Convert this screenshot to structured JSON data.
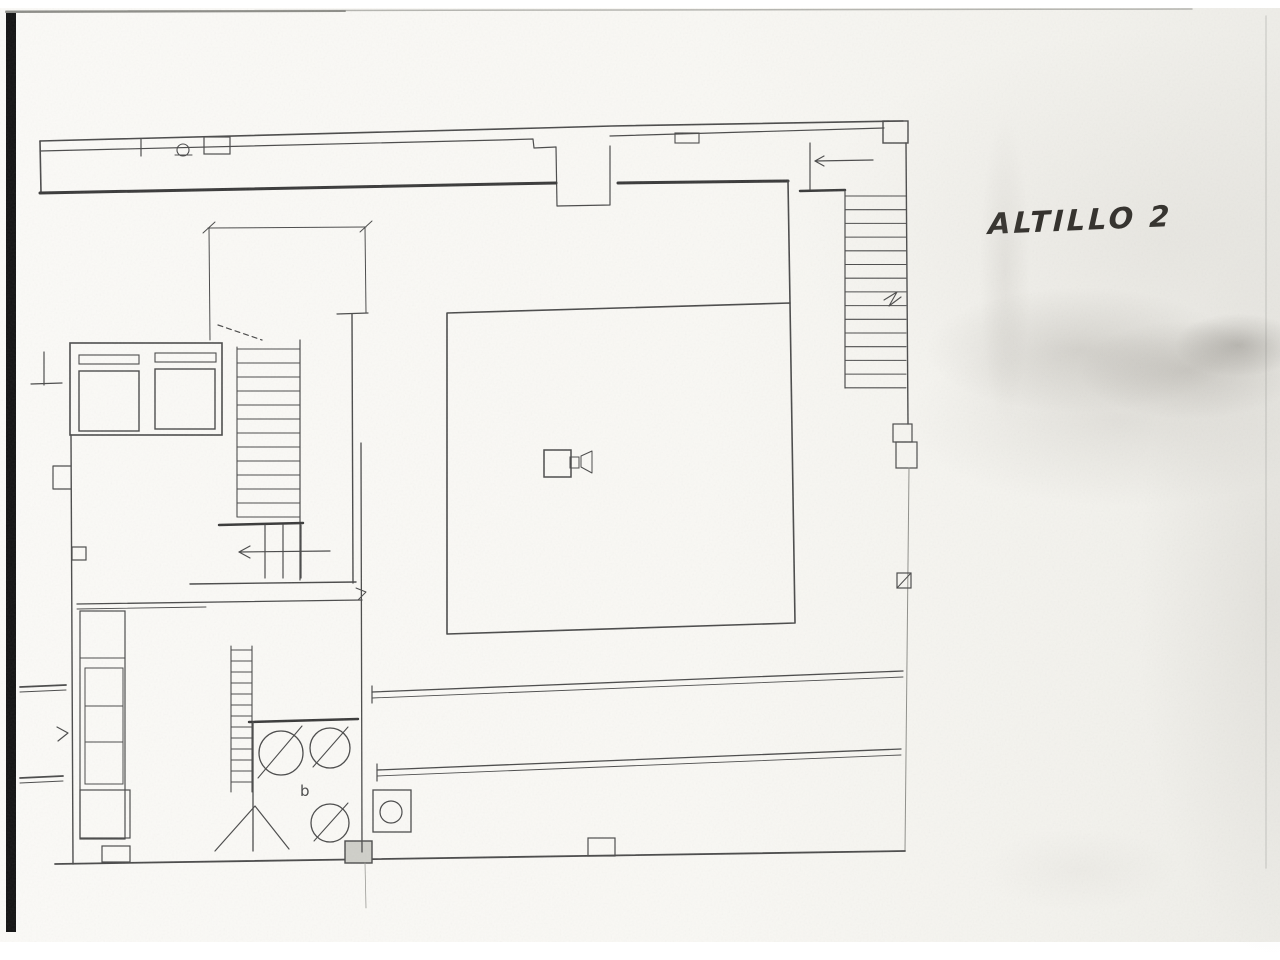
{
  "page": {
    "background": "#ffffff",
    "paper_color": "#f9f8f4",
    "ink_color": "#4b4b4b",
    "heavy_ink_color": "#3a3a3a",
    "faint_ink_color": "#8f8f8a",
    "scan_bar_color": "#111111"
  },
  "label": {
    "text": "ALTILLO 2"
  },
  "drawing": {
    "width": 1280,
    "height": 960,
    "elements": [
      {
        "n": "scan-left-bar",
        "t": "rect",
        "x": 6,
        "y": 12,
        "wd": 10,
        "ht": 920,
        "sw": 0,
        "fill": "#131313"
      },
      {
        "n": "scan-top-edge",
        "t": "line",
        "x1": 6,
        "y1": 11,
        "x2": 1192,
        "y2": 9,
        "w": 1.5,
        "color": "#b5b5b0"
      },
      {
        "n": "scan-top-edge-dark",
        "t": "line",
        "x1": 6,
        "y1": 12,
        "x2": 345,
        "y2": 11,
        "w": 2,
        "color": "#8d8d88"
      },
      {
        "n": "scan-right-edge",
        "t": "line",
        "x1": 1266,
        "y1": 16,
        "x2": 1266,
        "y2": 868,
        "w": 1.5,
        "color": "#d2d2cd"
      },
      {
        "n": "top-wall-outer",
        "t": "polyline",
        "pts": [
          [
            40,
            141
          ],
          [
            540,
            128
          ],
          [
            612,
            126
          ],
          [
            903,
            121
          ]
        ],
        "w": 1.6
      },
      {
        "n": "top-wall-inner-left",
        "t": "polyline",
        "pts": [
          [
            40,
            151
          ],
          [
            500,
            140
          ],
          [
            533,
            139
          ],
          [
            534,
            148
          ],
          [
            556,
            147
          ]
        ],
        "w": 1.2
      },
      {
        "n": "entry-vestibule-outline",
        "t": "polyline",
        "pts": [
          [
            556,
            147
          ],
          [
            557,
            206
          ],
          [
            610,
            205
          ],
          [
            610,
            146
          ]
        ],
        "w": 1.2
      },
      {
        "n": "top-wall-inner-right",
        "t": "line",
        "x1": 610,
        "y1": 136,
        "x2": 884,
        "y2": 128,
        "w": 1.2
      },
      {
        "n": "top-wall-box",
        "t": "rect",
        "x": 675,
        "y": 133,
        "wd": 24,
        "ht": 10,
        "sw": 1.1
      },
      {
        "n": "top-wall-pilaster",
        "t": "rect",
        "x": 204,
        "y": 137,
        "wd": 26,
        "ht": 17,
        "sw": 1.2
      },
      {
        "n": "top-wall-tick",
        "t": "line",
        "x1": 141,
        "y1": 139,
        "x2": 141,
        "y2": 156,
        "w": 1.2
      },
      {
        "n": "top-wall-circle-detail",
        "t": "circle",
        "cx": 183,
        "cy": 150,
        "r": 6,
        "w": 1.1
      },
      {
        "n": "top-wall-circle-base",
        "t": "line",
        "x1": 175,
        "y1": 155,
        "x2": 192,
        "y2": 155,
        "w": 1.1
      },
      {
        "n": "left-wall-top",
        "t": "line",
        "x1": 40,
        "y1": 141,
        "x2": 41,
        "y2": 193,
        "w": 1.6
      },
      {
        "n": "interior-wall-left-heavy",
        "t": "line",
        "x1": 40,
        "y1": 193,
        "x2": 556,
        "y2": 183,
        "w": 3,
        "color": "#3a3a3a"
      },
      {
        "n": "interior-wall-right-heavy",
        "t": "line",
        "x1": 618,
        "y1": 183,
        "x2": 788,
        "y2": 181,
        "w": 3,
        "color": "#3a3a3a"
      },
      {
        "n": "top-right-corner-box",
        "t": "rect",
        "x": 883,
        "y": 121,
        "wd": 25,
        "ht": 22,
        "sw": 1.4
      },
      {
        "n": "right-wall-upper",
        "t": "line",
        "x1": 906,
        "y1": 143,
        "x2": 908,
        "y2": 424,
        "w": 1.4
      },
      {
        "n": "right-wall-pilaster-a",
        "t": "rect",
        "x": 893,
        "y": 424,
        "wd": 19,
        "ht": 18,
        "sw": 1.2
      },
      {
        "n": "right-wall-pilaster-b",
        "t": "rect",
        "x": 896,
        "y": 442,
        "wd": 21,
        "ht": 26,
        "sw": 1.2
      },
      {
        "n": "right-wall-lower",
        "t": "line",
        "x1": 909,
        "y1": 468,
        "x2": 905,
        "y2": 851,
        "w": 1,
        "color": "#8f8f8a"
      },
      {
        "n": "wall-outlet-symbol-box",
        "t": "rect",
        "x": 897,
        "y": 573,
        "wd": 14,
        "ht": 15,
        "sw": 1.2
      },
      {
        "n": "wall-outlet-symbol-slash",
        "t": "line",
        "x1": 897,
        "y1": 588,
        "x2": 911,
        "y2": 573,
        "w": 1
      },
      {
        "n": "bottom-wall",
        "t": "line",
        "x1": 55,
        "y1": 864,
        "x2": 905,
        "y2": 851,
        "w": 1.8
      },
      {
        "n": "bottom-wall-box-a",
        "t": "rect",
        "x": 345,
        "y": 841,
        "wd": 27,
        "ht": 22,
        "sw": 1.4,
        "fill": "#cfcfc9"
      },
      {
        "n": "bottom-wall-box-b",
        "t": "rect",
        "x": 588,
        "y": 838,
        "wd": 27,
        "ht": 18,
        "sw": 1.2
      },
      {
        "n": "fold-line-bottom",
        "t": "line",
        "x1": 365,
        "y1": 863,
        "x2": 366,
        "y2": 908,
        "w": 0.8,
        "color": "#9a9a95"
      },
      {
        "n": "left-wall-lower",
        "t": "line",
        "x1": 71,
        "y1": 435,
        "x2": 73,
        "y2": 864,
        "w": 1.4
      },
      {
        "n": "left-wall-protrusion",
        "t": "polyline",
        "pts": [
          [
            71,
            466
          ],
          [
            53,
            466
          ],
          [
            53,
            489
          ],
          [
            71,
            489
          ]
        ],
        "w": 1.2
      },
      {
        "n": "left-wall-box",
        "t": "rect",
        "x": 72,
        "y": 547,
        "wd": 14,
        "ht": 13,
        "sw": 1.2
      },
      {
        "n": "left-stub-upper-a",
        "t": "line",
        "x1": 20,
        "y1": 687,
        "x2": 66,
        "y2": 685,
        "w": 1.8
      },
      {
        "n": "left-stub-upper-b",
        "t": "line",
        "x1": 20,
        "y1": 692,
        "x2": 66,
        "y2": 690,
        "w": 1
      },
      {
        "n": "left-stub-lower-a",
        "t": "line",
        "x1": 20,
        "y1": 778,
        "x2": 63,
        "y2": 776,
        "w": 1.8
      },
      {
        "n": "left-stub-lower-b",
        "t": "line",
        "x1": 20,
        "y1": 783,
        "x2": 63,
        "y2": 781,
        "w": 1
      },
      {
        "n": "left-wall-zigzag",
        "t": "polyline",
        "pts": [
          [
            57,
            727
          ],
          [
            68,
            733
          ],
          [
            58,
            741
          ]
        ],
        "w": 1.2
      },
      {
        "n": "left-bracket-v",
        "t": "line",
        "x1": 44,
        "y1": 352,
        "x2": 44,
        "y2": 385,
        "w": 1.2
      },
      {
        "n": "left-bracket-h",
        "t": "line",
        "x1": 31,
        "y1": 384,
        "x2": 62,
        "y2": 383,
        "w": 1.2
      },
      {
        "n": "dim-line-h",
        "t": "line",
        "x1": 208,
        "y1": 228,
        "x2": 366,
        "y2": 227,
        "w": 1
      },
      {
        "n": "dim-line-v-left",
        "t": "line",
        "x1": 209,
        "y1": 228,
        "x2": 210,
        "y2": 340,
        "w": 1
      },
      {
        "n": "dim-line-v-right",
        "t": "line",
        "x1": 365,
        "y1": 227,
        "x2": 366,
        "y2": 313,
        "w": 1
      },
      {
        "n": "dim-tick-left",
        "t": "line",
        "x1": 203,
        "y1": 233,
        "x2": 215,
        "y2": 222,
        "w": 1
      },
      {
        "n": "dim-tick-right",
        "t": "line",
        "x1": 360,
        "y1": 232,
        "x2": 372,
        "y2": 221,
        "w": 1
      },
      {
        "n": "elevator-shaft",
        "t": "rect",
        "x": 70,
        "y": 343,
        "wd": 152,
        "ht": 92,
        "sw": 1.6
      },
      {
        "n": "elevator-door-left",
        "t": "rect",
        "x": 79,
        "y": 355,
        "wd": 60,
        "ht": 9,
        "sw": 1.1
      },
      {
        "n": "elevator-door-right",
        "t": "rect",
        "x": 155,
        "y": 353,
        "wd": 61,
        "ht": 9,
        "sw": 1.1
      },
      {
        "n": "elevator-cab-left",
        "t": "rect",
        "x": 79,
        "y": 371,
        "wd": 60,
        "ht": 60,
        "sw": 1.4
      },
      {
        "n": "elevator-cab-right",
        "t": "rect",
        "x": 155,
        "y": 369,
        "wd": 60,
        "ht": 60,
        "sw": 1.4
      },
      {
        "n": "stair-dashed-diagonal",
        "t": "line",
        "x1": 218,
        "y1": 325,
        "x2": 262,
        "y2": 340,
        "w": 1.2,
        "dash": "5,4"
      },
      {
        "n": "stair-left-rail",
        "t": "line",
        "x1": 237,
        "y1": 347,
        "x2": 237,
        "y2": 517,
        "w": 1.1
      },
      {
        "n": "stair-mid-rail",
        "t": "line",
        "x1": 300,
        "y1": 340,
        "x2": 300,
        "y2": 580,
        "w": 1.2
      },
      {
        "n": "stair-wall-right",
        "t": "line",
        "x1": 352,
        "y1": 314,
        "x2": 353,
        "y2": 583,
        "w": 1.4
      },
      {
        "n": "stair-wall-top-tick",
        "t": "line",
        "x1": 337,
        "y1": 314,
        "x2": 368,
        "y2": 313,
        "w": 1.2
      },
      {
        "n": "stair-treads-upper",
        "t": "hlines",
        "x1": 237,
        "x2": 300,
        "y": 349,
        "step": 14,
        "count": 13,
        "w": 1.05
      },
      {
        "n": "ministair-heavy-wall",
        "t": "line",
        "x1": 219,
        "y1": 525,
        "x2": 303,
        "y2": 523,
        "w": 2.5,
        "color": "#3a3a3a"
      },
      {
        "n": "ministair-treads",
        "t": "vlines",
        "y1": 525,
        "y2": 578,
        "x": 265,
        "step": 18,
        "count": 3,
        "w": 1.2
      },
      {
        "n": "ministair-arrow-shaft",
        "t": "line",
        "x1": 239,
        "y1": 552,
        "x2": 330,
        "y2": 551,
        "w": 1.2
      },
      {
        "n": "ministair-arrow-head",
        "t": "polyline",
        "pts": [
          [
            250,
            546
          ],
          [
            239,
            552
          ],
          [
            250,
            558
          ]
        ],
        "w": 1.2
      },
      {
        "n": "wall-below-ministair",
        "t": "line",
        "x1": 190,
        "y1": 584,
        "x2": 356,
        "y2": 582,
        "w": 1.4
      },
      {
        "n": "wall-corner-mark",
        "t": "polyline",
        "pts": [
          [
            356,
            588
          ],
          [
            366,
            592
          ],
          [
            358,
            600
          ]
        ],
        "w": 1
      },
      {
        "n": "main-room-outline",
        "t": "polyline",
        "pts": [
          [
            447,
            313
          ],
          [
            447,
            634
          ],
          [
            795,
            623
          ],
          [
            790,
            303
          ],
          [
            447,
            313
          ]
        ],
        "w": 1.6
      },
      {
        "n": "main-room-right-wall-upper",
        "t": "line",
        "x1": 788,
        "y1": 181,
        "x2": 790,
        "y2": 303,
        "w": 1.6
      },
      {
        "n": "room-column",
        "t": "rect",
        "x": 544,
        "y": 450,
        "wd": 27,
        "ht": 27,
        "sw": 1.5
      },
      {
        "n": "column-marker-box",
        "t": "rect",
        "x": 570,
        "y": 457,
        "wd": 9,
        "ht": 11,
        "sw": 1
      },
      {
        "n": "column-marker-tri",
        "t": "polyline",
        "pts": [
          [
            581,
            456
          ],
          [
            592,
            451
          ],
          [
            592,
            473
          ],
          [
            581,
            467
          ],
          [
            581,
            456
          ]
        ],
        "w": 1
      },
      {
        "n": "rstair-landing-wall",
        "t": "line",
        "x1": 810,
        "y1": 143,
        "x2": 810,
        "y2": 190,
        "w": 1.2
      },
      {
        "n": "rstair-arrow-shaft",
        "t": "line",
        "x1": 815,
        "y1": 161,
        "x2": 873,
        "y2": 160,
        "w": 1.2
      },
      {
        "n": "rstair-arrow-head",
        "t": "polyline",
        "pts": [
          [
            824,
            156
          ],
          [
            815,
            161
          ],
          [
            824,
            166
          ]
        ],
        "w": 1.2
      },
      {
        "n": "rstair-entry-heavy",
        "t": "line",
        "x1": 800,
        "y1": 191,
        "x2": 845,
        "y2": 190,
        "w": 2.5,
        "color": "#3a3a3a"
      },
      {
        "n": "rstair-left-rail",
        "t": "line",
        "x1": 845,
        "y1": 190,
        "x2": 845,
        "y2": 388,
        "w": 1.2
      },
      {
        "n": "rstair-treads",
        "t": "hlines",
        "x1": 845,
        "x2": 906,
        "y": 196,
        "step": 13.7,
        "count": 15,
        "w": 1.05
      },
      {
        "n": "rstair-break-mark",
        "t": "polyline",
        "pts": [
          [
            884,
            300
          ],
          [
            897,
            292
          ],
          [
            889,
            306
          ],
          [
            901,
            297
          ]
        ],
        "w": 1.1
      },
      {
        "n": "gallery-rail-upper-a",
        "t": "line",
        "x1": 372,
        "y1": 692,
        "x2": 903,
        "y2": 671,
        "w": 1.3
      },
      {
        "n": "gallery-rail-upper-b",
        "t": "line",
        "x1": 372,
        "y1": 698,
        "x2": 903,
        "y2": 677,
        "w": 0.9
      },
      {
        "n": "gallery-rail-upper-end",
        "t": "line",
        "x1": 372,
        "y1": 686,
        "x2": 372,
        "y2": 703,
        "w": 1.2
      },
      {
        "n": "gallery-rail-lower-a",
        "t": "line",
        "x1": 377,
        "y1": 770,
        "x2": 901,
        "y2": 749,
        "w": 1.3
      },
      {
        "n": "gallery-rail-lower-b",
        "t": "line",
        "x1": 377,
        "y1": 776,
        "x2": 901,
        "y2": 755,
        "w": 0.9
      },
      {
        "n": "gallery-rail-lower-end",
        "t": "line",
        "x1": 377,
        "y1": 764,
        "x2": 377,
        "y2": 781,
        "w": 1.2
      },
      {
        "n": "lower-room-top-a",
        "t": "line",
        "x1": 77,
        "y1": 604,
        "x2": 362,
        "y2": 600,
        "w": 1.3
      },
      {
        "n": "lower-room-top-b",
        "t": "line",
        "x1": 77,
        "y1": 609,
        "x2": 206,
        "y2": 607,
        "w": 0.9
      },
      {
        "n": "cabinet-outer",
        "t": "rect",
        "x": 80,
        "y": 611,
        "wd": 45,
        "ht": 228,
        "sw": 1.2
      },
      {
        "n": "cabinet-top-divider",
        "t": "line",
        "x1": 80,
        "y1": 658,
        "x2": 125,
        "y2": 658,
        "w": 1
      },
      {
        "n": "cabinet-inner",
        "t": "rect",
        "x": 85,
        "y": 668,
        "wd": 38,
        "ht": 116,
        "sw": 1
      },
      {
        "n": "cabinet-divider-a",
        "t": "line",
        "x1": 85,
        "y1": 706,
        "x2": 123,
        "y2": 706,
        "w": 1
      },
      {
        "n": "cabinet-divider-b",
        "t": "line",
        "x1": 85,
        "y1": 742,
        "x2": 123,
        "y2": 742,
        "w": 1
      },
      {
        "n": "cabinet-bottom-box",
        "t": "rect",
        "x": 80,
        "y": 790,
        "wd": 50,
        "ht": 48,
        "sw": 1.2
      },
      {
        "n": "cabinet-foot-box",
        "t": "rect",
        "x": 102,
        "y": 846,
        "wd": 28,
        "ht": 16,
        "sw": 1.2
      },
      {
        "n": "shelf-hatch-left",
        "t": "line",
        "x1": 231,
        "y1": 646,
        "x2": 231,
        "y2": 792,
        "w": 1.1
      },
      {
        "n": "shelf-hatch-right",
        "t": "line",
        "x1": 252,
        "y1": 646,
        "x2": 252,
        "y2": 792,
        "w": 1.1
      },
      {
        "n": "shelf-hatch-rungs",
        "t": "hlines",
        "x1": 231,
        "x2": 252,
        "y": 650,
        "step": 11,
        "count": 13,
        "w": 1.05
      },
      {
        "n": "kitchen-wall-top-heavy",
        "t": "line",
        "x1": 249,
        "y1": 722,
        "x2": 358,
        "y2": 719,
        "w": 2.5,
        "color": "#3a3a3a"
      },
      {
        "n": "kitchen-wall-left",
        "t": "line",
        "x1": 253,
        "y1": 722,
        "x2": 253,
        "y2": 851,
        "w": 1.3
      },
      {
        "n": "kitchen-wall-right",
        "t": "line",
        "x1": 361,
        "y1": 443,
        "x2": 362,
        "y2": 852,
        "w": 1.3
      },
      {
        "n": "basin-a",
        "t": "circle",
        "cx": 281,
        "cy": 753,
        "r": 22,
        "w": 1.3
      },
      {
        "n": "basin-a-slash",
        "t": "line",
        "x1": 258,
        "y1": 778,
        "x2": 302,
        "y2": 726,
        "w": 1.1
      },
      {
        "n": "basin-b",
        "t": "circle",
        "cx": 330,
        "cy": 748,
        "r": 20,
        "w": 1.3
      },
      {
        "n": "basin-b-slash",
        "t": "line",
        "x1": 313,
        "y1": 767,
        "x2": 348,
        "y2": 727,
        "w": 1.1
      },
      {
        "n": "fixture-letter",
        "t": "text",
        "x": 300,
        "y": 796,
        "text": "b",
        "size": 15
      },
      {
        "n": "basin-c",
        "t": "circle",
        "cx": 330,
        "cy": 823,
        "r": 19,
        "w": 1.3
      },
      {
        "n": "basin-c-slash",
        "t": "line",
        "x1": 314,
        "y1": 841,
        "x2": 348,
        "y2": 803,
        "w": 1.1
      },
      {
        "n": "door-swing-mark",
        "t": "polyline",
        "pts": [
          [
            215,
            851
          ],
          [
            255,
            806
          ],
          [
            289,
            849
          ]
        ],
        "w": 1.2
      },
      {
        "n": "wc-box",
        "t": "rect",
        "x": 373,
        "y": 790,
        "wd": 38,
        "ht": 42,
        "sw": 1.3
      },
      {
        "n": "wc-bowl",
        "t": "circle",
        "cx": 391,
        "cy": 812,
        "r": 11,
        "w": 1.2
      }
    ]
  }
}
